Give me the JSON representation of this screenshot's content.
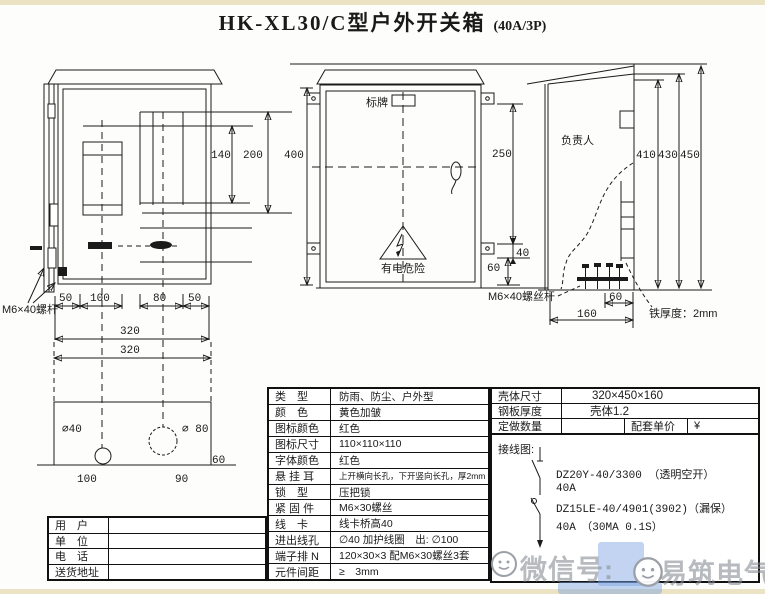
{
  "page": {
    "title": "HK-XL30/C型户外开关箱",
    "title_suffix": "(40A/3P)"
  },
  "dims": {
    "d50a": "50",
    "d100": "100",
    "d80": "80",
    "d50b": "50",
    "d320a": "320",
    "d320b": "320",
    "d140": "140",
    "d200": "200",
    "d400": "400",
    "d250": "250",
    "d40": "40",
    "d60a": "60",
    "d410": "410",
    "d430": "430",
    "d450": "450",
    "d60b": "60",
    "d160": "160",
    "hole40": "∅40",
    "hole80": "∅ 80",
    "b100": "100",
    "b90": "90",
    "b60": "60"
  },
  "labels": {
    "bolt_left": "M6×40螺杆",
    "bolt_mid": "M6×40螺丝杆",
    "nameplate": "标牌",
    "warning": "有电危险",
    "person": "负责人",
    "thickness": "铁厚度：2mm"
  },
  "spec": {
    "rows": [
      {
        "label": "类　型",
        "value": "防雨、防尘、户外型"
      },
      {
        "label": "颜　色",
        "value": "黄色加皱"
      },
      {
        "label": "图标颜色",
        "value": "红色"
      },
      {
        "label": "图标尺寸",
        "value": "110×110×110"
      },
      {
        "label": "字体颜色",
        "value": "红色"
      },
      {
        "label": "悬 挂 耳",
        "value": "上开横向长孔，下开竖向长孔，厚2mm"
      },
      {
        "label": "锁　型",
        "value": "压把锁"
      },
      {
        "label": "紧 固 件",
        "value": "M6×30螺丝"
      },
      {
        "label": "线　卡",
        "value": "线卡桥高40"
      },
      {
        "label": "进出线孔",
        "value": "∅40 加护线圈　出: ∅100"
      },
      {
        "label": "端子排 N",
        "value": "120×30×3 配M6×30螺丝3套"
      },
      {
        "label": "元件间距",
        "value": "≥　3mm"
      }
    ]
  },
  "order": {
    "rows": [
      {
        "label": "壳体尺寸",
        "value": "320×450×160"
      },
      {
        "label": "钢板厚度",
        "value": "壳体1.2"
      }
    ],
    "qty_label": "定做数量",
    "qty_value": "",
    "unit_label": "配套单价",
    "unit_value": "¥"
  },
  "wiring": {
    "title": "接线图:",
    "line1": "DZ20Y-40/3300 （透明空开）",
    "line2": "40A",
    "line3": "DZ15LE-40/4901(3902)（漏保）",
    "line4": "40A　（30MA 0.1S）"
  },
  "customer": {
    "rows": [
      {
        "label": "用　户",
        "value": ""
      },
      {
        "label": "单　位",
        "value": ""
      },
      {
        "label": "电　话",
        "value": ""
      },
      {
        "label": "送货地址",
        "value": ""
      }
    ]
  },
  "watermark": {
    "prefix": "微信号:",
    "suffix": "易筑电气"
  }
}
